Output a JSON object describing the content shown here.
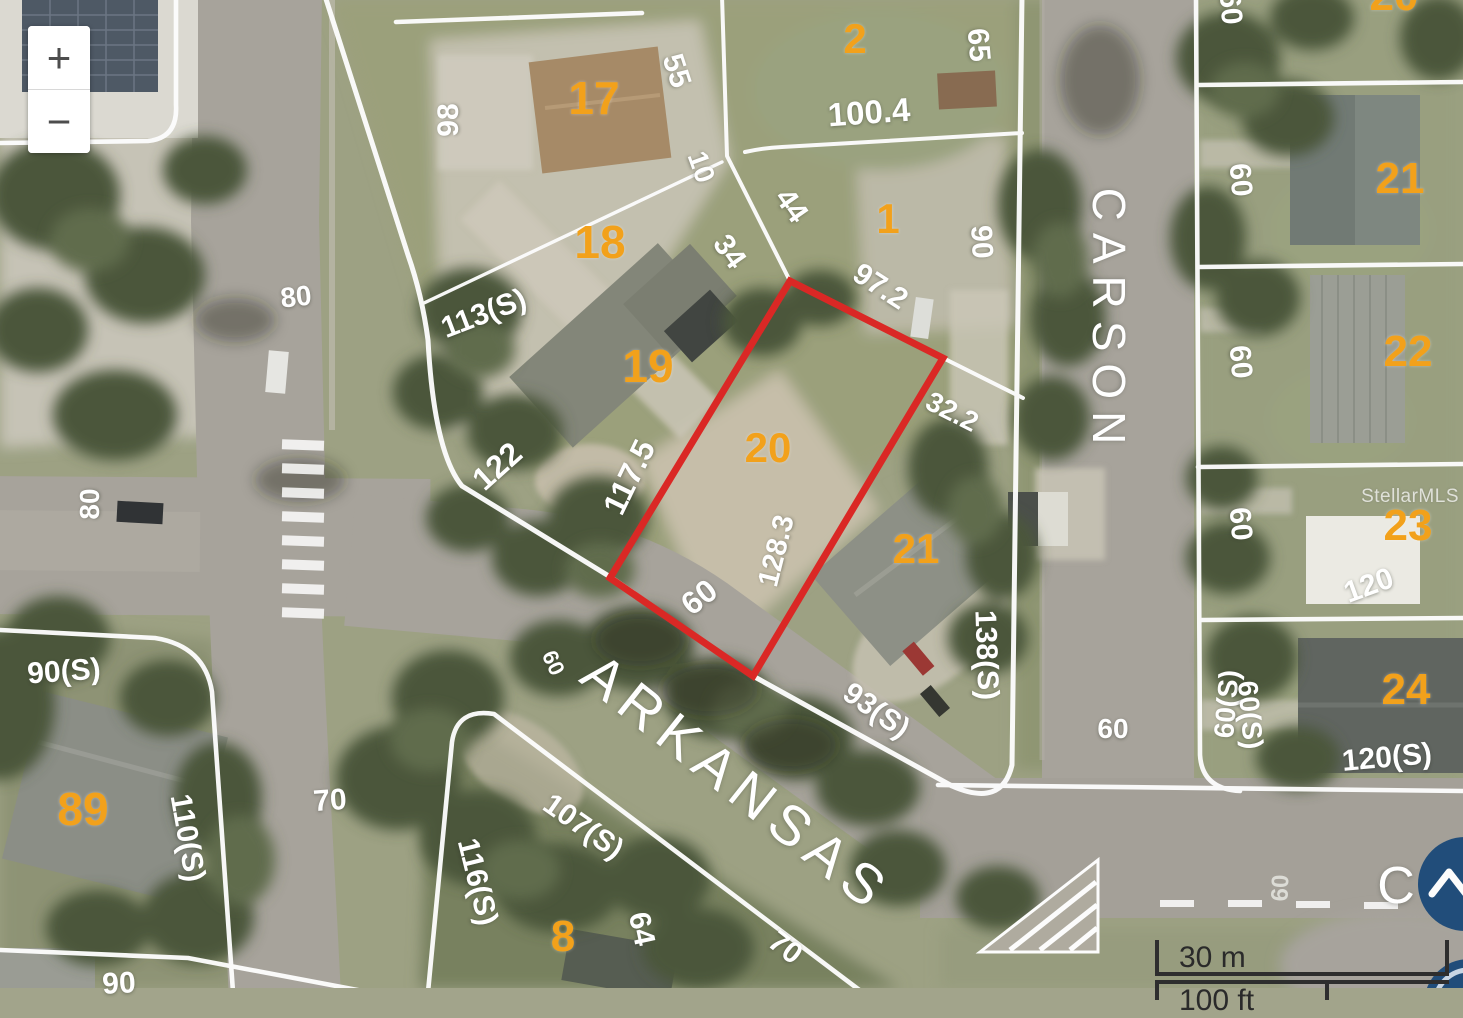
{
  "map": {
    "type": "parcel-aerial-map",
    "watermark": "StellarMLS",
    "controls": {
      "zoom_in": "+",
      "zoom_out": "−",
      "scroll_top_icon": "chevron-up-icon"
    },
    "scale_bar": {
      "metric": "30 m",
      "imperial": "100 ft"
    },
    "colors": {
      "highlight": "#e8231f",
      "lot_number": "#f2a11b",
      "dimension_text": "#ffffff",
      "street_text": "#ffffff",
      "button_blue": "#1c4d7e",
      "scale_text": "#2a2a2a",
      "parcel_line": "#ffffff"
    },
    "highlighted_parcel": {
      "lot": "20",
      "outline_color": "#e8231f",
      "points": [
        [
          790,
          281
        ],
        [
          943,
          358
        ],
        [
          753,
          676
        ],
        [
          610,
          578
        ]
      ]
    },
    "labels": {
      "lots": [
        {
          "t": "17",
          "x": 594,
          "y": 98,
          "r": 0,
          "s": 46
        },
        {
          "t": "18",
          "x": 600,
          "y": 242,
          "r": 0,
          "s": 46
        },
        {
          "t": "19",
          "x": 648,
          "y": 366,
          "r": 0,
          "s": 46
        },
        {
          "t": "20",
          "x": 768,
          "y": 448,
          "r": 0,
          "s": 42
        },
        {
          "t": "21",
          "x": 916,
          "y": 549,
          "r": 0,
          "s": 42
        },
        {
          "t": "2",
          "x": 855,
          "y": 39,
          "r": 0,
          "s": 42
        },
        {
          "t": "1",
          "x": 888,
          "y": 219,
          "r": 0,
          "s": 42
        },
        {
          "t": "20",
          "x": 1394,
          "y": -4,
          "r": 0,
          "s": 44
        },
        {
          "t": "21",
          "x": 1400,
          "y": 179,
          "r": 0,
          "s": 44
        },
        {
          "t": "22",
          "x": 1408,
          "y": 352,
          "r": 0,
          "s": 44
        },
        {
          "t": "23",
          "x": 1408,
          "y": 526,
          "r": 0,
          "s": 44
        },
        {
          "t": "24",
          "x": 1406,
          "y": 690,
          "r": 0,
          "s": 44
        },
        {
          "t": "89",
          "x": 83,
          "y": 809,
          "r": 0,
          "s": 46
        },
        {
          "t": "8",
          "x": 563,
          "y": 937,
          "r": 0,
          "s": 44
        }
      ],
      "dims": [
        {
          "t": "98",
          "x": 449,
          "y": 120,
          "r": -90,
          "s": 30
        },
        {
          "t": "55",
          "x": 676,
          "y": 71,
          "r": 72,
          "s": 30
        },
        {
          "t": "10",
          "x": 701,
          "y": 167,
          "r": 70,
          "s": 28
        },
        {
          "t": "44",
          "x": 791,
          "y": 206,
          "r": 55,
          "s": 30
        },
        {
          "t": "34",
          "x": 729,
          "y": 252,
          "r": 55,
          "s": 30
        },
        {
          "t": "100.4",
          "x": 869,
          "y": 112,
          "r": -4,
          "s": 33
        },
        {
          "t": "65",
          "x": 978,
          "y": 45,
          "r": 85,
          "s": 30
        },
        {
          "t": "90",
          "x": 981,
          "y": 242,
          "r": 87,
          "s": 30
        },
        {
          "t": "97.2",
          "x": 880,
          "y": 287,
          "r": 33,
          "s": 30
        },
        {
          "t": "113(S)",
          "x": 484,
          "y": 314,
          "r": -21,
          "s": 30
        },
        {
          "t": "122",
          "x": 497,
          "y": 466,
          "r": -42,
          "s": 32
        },
        {
          "t": "117.5",
          "x": 629,
          "y": 477,
          "r": -64,
          "s": 32
        },
        {
          "t": "32.2",
          "x": 952,
          "y": 412,
          "r": 27,
          "s": 28
        },
        {
          "t": "128.3",
          "x": 777,
          "y": 551,
          "r": -76,
          "s": 29
        },
        {
          "t": "60",
          "x": 699,
          "y": 597,
          "r": -38,
          "s": 32
        },
        {
          "t": "60",
          "x": 553,
          "y": 663,
          "r": 65,
          "s": 22
        },
        {
          "t": "93(S)",
          "x": 876,
          "y": 711,
          "r": 35,
          "s": 30
        },
        {
          "t": "138(S)",
          "x": 986,
          "y": 655,
          "r": 88,
          "s": 30
        },
        {
          "t": "60",
          "x": 1113,
          "y": 729,
          "r": 0,
          "s": 28
        },
        {
          "t": "107(S)",
          "x": 583,
          "y": 827,
          "r": 35,
          "s": 30
        },
        {
          "t": "116(S)",
          "x": 477,
          "y": 882,
          "r": 76,
          "s": 30
        },
        {
          "t": "110(S)",
          "x": 187,
          "y": 838,
          "r": 80,
          "s": 30
        },
        {
          "t": "90(S)",
          "x": 64,
          "y": 672,
          "r": -4,
          "s": 30
        },
        {
          "t": "70",
          "x": 330,
          "y": 801,
          "r": -4,
          "s": 30
        },
        {
          "t": "70",
          "x": 785,
          "y": 948,
          "r": 38,
          "s": 30
        },
        {
          "t": "64",
          "x": 641,
          "y": 929,
          "r": 78,
          "s": 30
        },
        {
          "t": "80",
          "x": 296,
          "y": 297,
          "r": -6,
          "s": 28
        },
        {
          "t": "80",
          "x": 90,
          "y": 504,
          "r": -90,
          "s": 28
        },
        {
          "t": "90",
          "x": 119,
          "y": 984,
          "r": -3,
          "s": 30
        },
        {
          "t": "120",
          "x": 1369,
          "y": 586,
          "r": -20,
          "s": 30
        },
        {
          "t": "120(S)",
          "x": 1387,
          "y": 758,
          "r": -5,
          "s": 30
        },
        {
          "t": "60",
          "x": 1230,
          "y": 8,
          "r": 85,
          "s": 30
        },
        {
          "t": "60",
          "x": 1240,
          "y": 180,
          "r": 85,
          "s": 30
        },
        {
          "t": "60",
          "x": 1240,
          "y": 362,
          "r": 85,
          "s": 30
        },
        {
          "t": "60",
          "x": 1240,
          "y": 524,
          "r": 85,
          "s": 30
        },
        {
          "t": "60(S)",
          "x": 1227,
          "y": 704,
          "r": -85,
          "s": 28
        },
        {
          "t": "60(S)",
          "x": 1250,
          "y": 715,
          "r": 85,
          "s": 28
        }
      ],
      "roads": [
        {
          "t": "60",
          "x": 1281,
          "y": 888,
          "r": -88,
          "s": 24
        }
      ],
      "streets": [
        {
          "t": "ARKANSAS",
          "x": 737,
          "y": 783,
          "r": 38.5,
          "s": 56,
          "ls": 9
        },
        {
          "t": "CARSON",
          "x": 1109,
          "y": 322,
          "r": 90,
          "s": 46,
          "ls": 12
        },
        {
          "t": "C",
          "x": 1396,
          "y": 886,
          "r": 0,
          "s": 52,
          "ls": 0
        }
      ]
    }
  }
}
